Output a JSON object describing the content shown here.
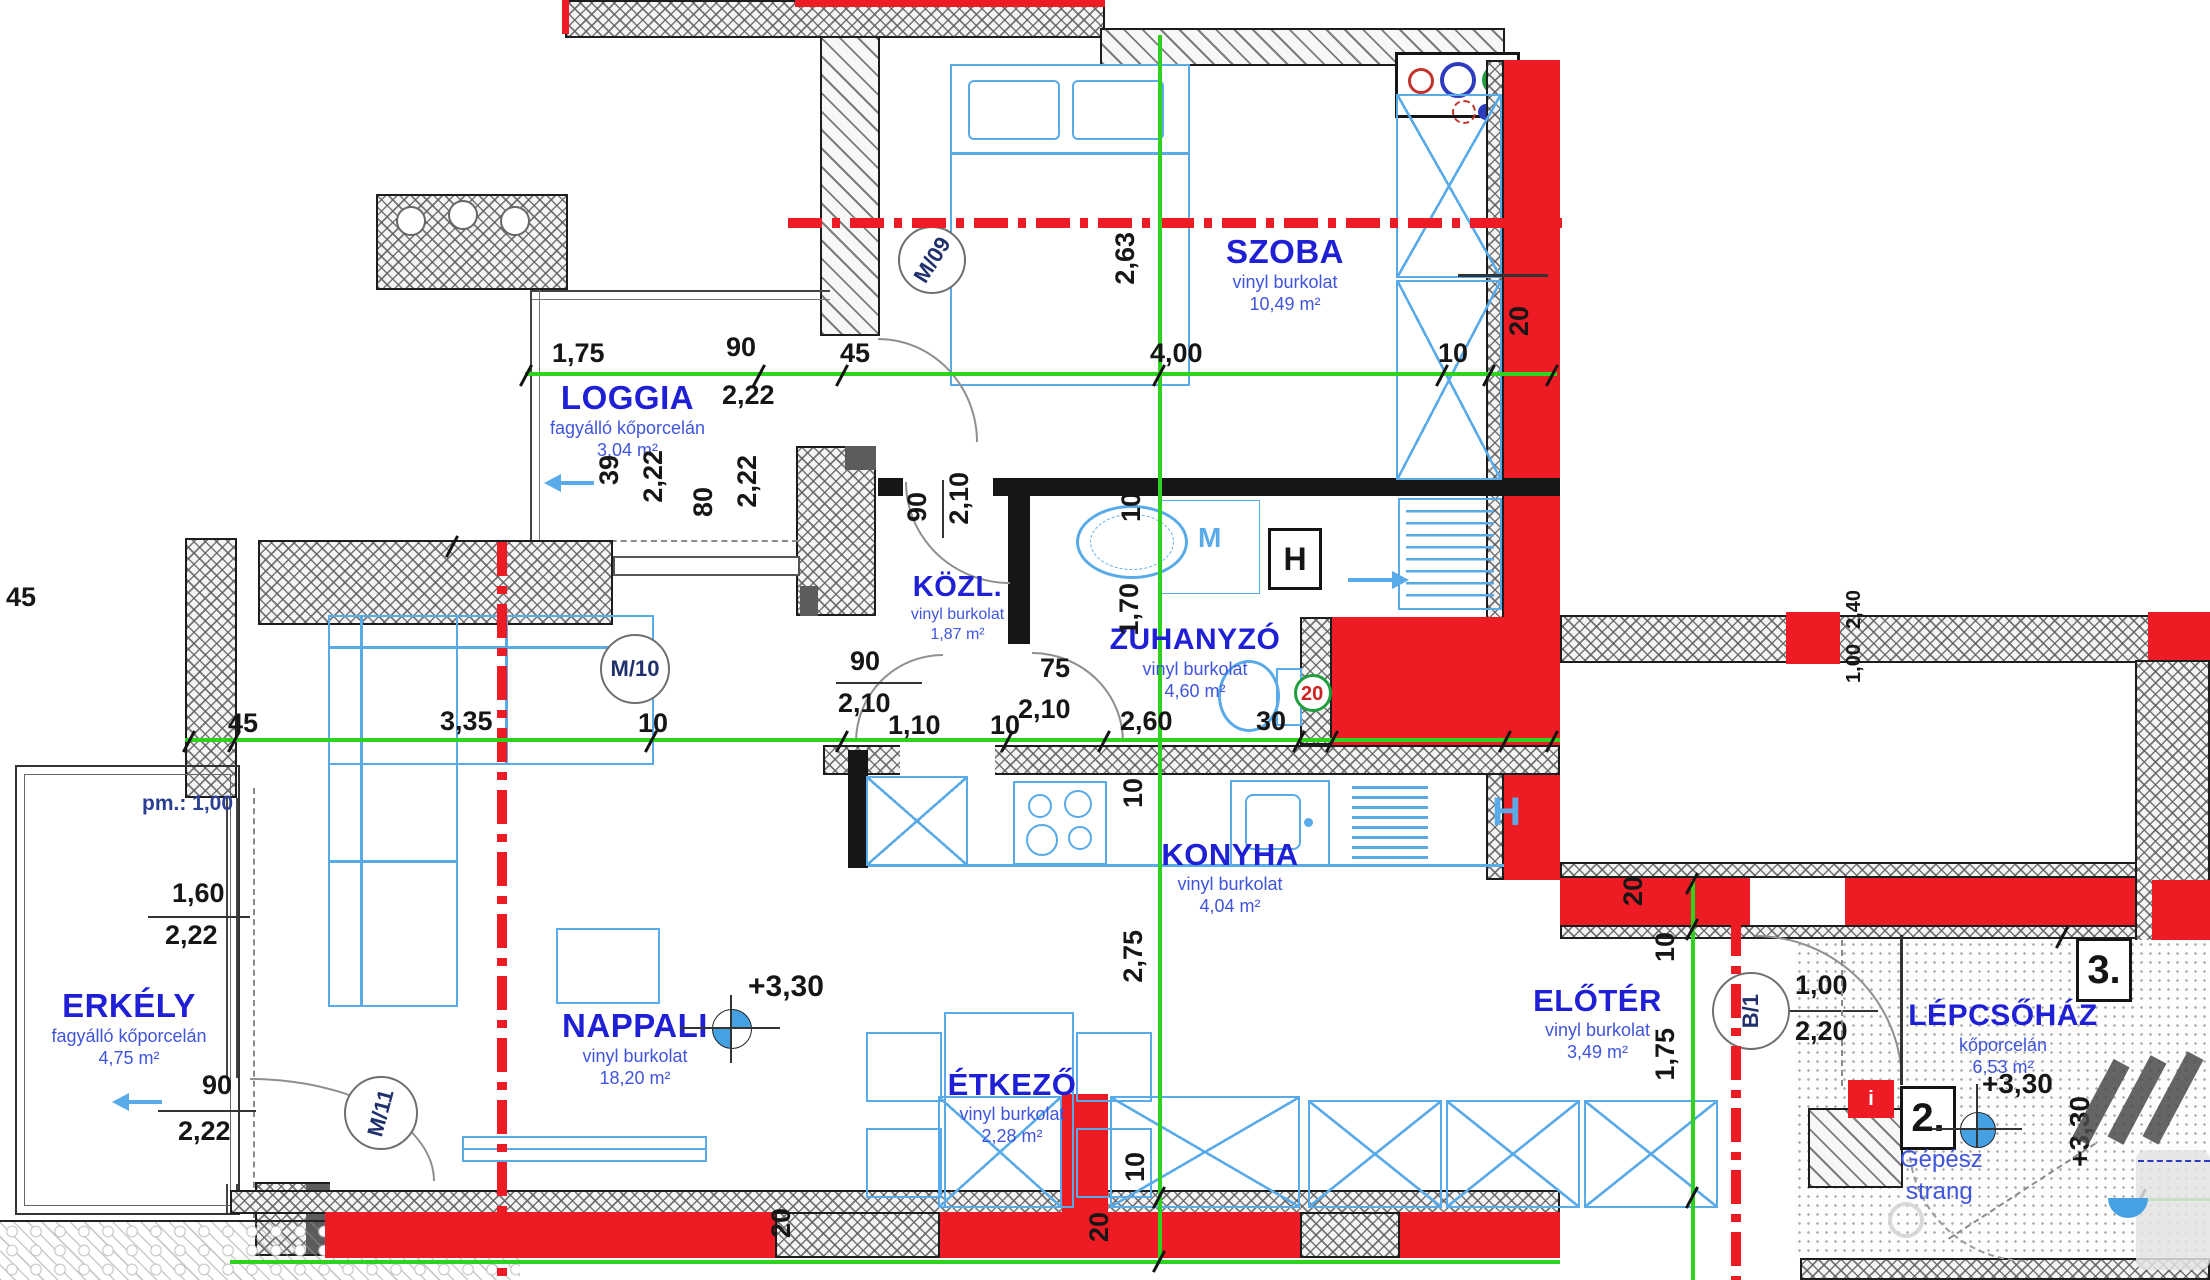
{
  "colors": {
    "label_blue": "#1f1fd6",
    "sub_blue": "#4055dd",
    "dim_black": "#161616",
    "wall_red": "#ed1c24",
    "dim_green": "#2ed31e",
    "furniture_blue": "#58aae8"
  },
  "rooms": {
    "szoba": {
      "name": "SZOBA",
      "finish": "vinyl burkolat",
      "area": "10,49 m²"
    },
    "loggia": {
      "name": "LOGGIA",
      "finish": "fagyálló kőporcelán",
      "area": "3,04 m²"
    },
    "kozl": {
      "name": "KÖZL.",
      "finish": "vinyl burkolat",
      "area": "1,87 m²"
    },
    "zuhanyzo": {
      "name": "ZUHANYZÓ",
      "finish": "vinyl burkolat",
      "area": "4,60 m²"
    },
    "konyha": {
      "name": "KONYHA",
      "finish": "vinyl burkolat",
      "area": "4,04 m²"
    },
    "nappali": {
      "name": "NAPPALI",
      "finish": "vinyl burkolat",
      "area": "18,20 m²"
    },
    "etkezo": {
      "name": "ÉTKEZŐ",
      "finish": "vinyl burkolat",
      "area": "2,28 m²"
    },
    "erkely": {
      "name": "ERKÉLY",
      "finish": "fagyálló kőporcelán",
      "area": "4,75 m²"
    },
    "eloter": {
      "name": "ELŐTÉR",
      "finish": "vinyl burkolat",
      "area": "3,49 m²"
    },
    "lepcsohaz": {
      "name": "LÉPCSŐHÁZ",
      "finish": "kőporcelán",
      "area": "6,53 m²"
    }
  },
  "markers": {
    "m09": "M/09",
    "m10": "M/10",
    "m11": "M/11",
    "b1": "B/1",
    "unit2": "2.",
    "unit3": "3.",
    "washer": "M",
    "dryer": "H",
    "kitchen_h": "H",
    "entry_i": "i",
    "shaft1": "Gépész",
    "shaft2": "strang"
  },
  "levels": {
    "nappali": "+3,30",
    "stair": "+3,30",
    "stair_side": "+3,30"
  },
  "dims": {
    "loggia_w": "1,75",
    "door_top_w": "90",
    "door_top_off": "45",
    "loggia_wh": "2,22",
    "szoba_w": "4,00",
    "szoba_off": "10",
    "szoba_h": "2,63",
    "wall_top": "20",
    "lg1": "39",
    "lg2": "2,22",
    "lg3": "80",
    "lg4": "2,22",
    "kn_w": "90",
    "kn_h": "2,10",
    "ks_w": "90",
    "ks_h": "2,10",
    "pass": "1,10",
    "wall_left": "45",
    "nappali_w": "3,35",
    "off1": "10",
    "off2": "10",
    "zd_h": "2,10",
    "zd_w": "75",
    "z_v": "1,70",
    "z_off": "10",
    "z_w": "2,60",
    "z_wall": "30",
    "z_wall2": "20",
    "k_off": "10",
    "e_h": "2,75",
    "e_off": "10",
    "bw1": "20",
    "bw2": "20",
    "pm": "pm.: 1,00",
    "ew_w": "1,60",
    "ew_h": "2,22",
    "ed_w": "90",
    "ed_h": "2,22",
    "e_wall": "45",
    "elo_off": "10",
    "elo_h": "1,75",
    "elo_wall": "20",
    "entry_w": "1,00",
    "entry_h": "2,20",
    "sw_w": "1,00",
    "sw_h": "2,40"
  }
}
